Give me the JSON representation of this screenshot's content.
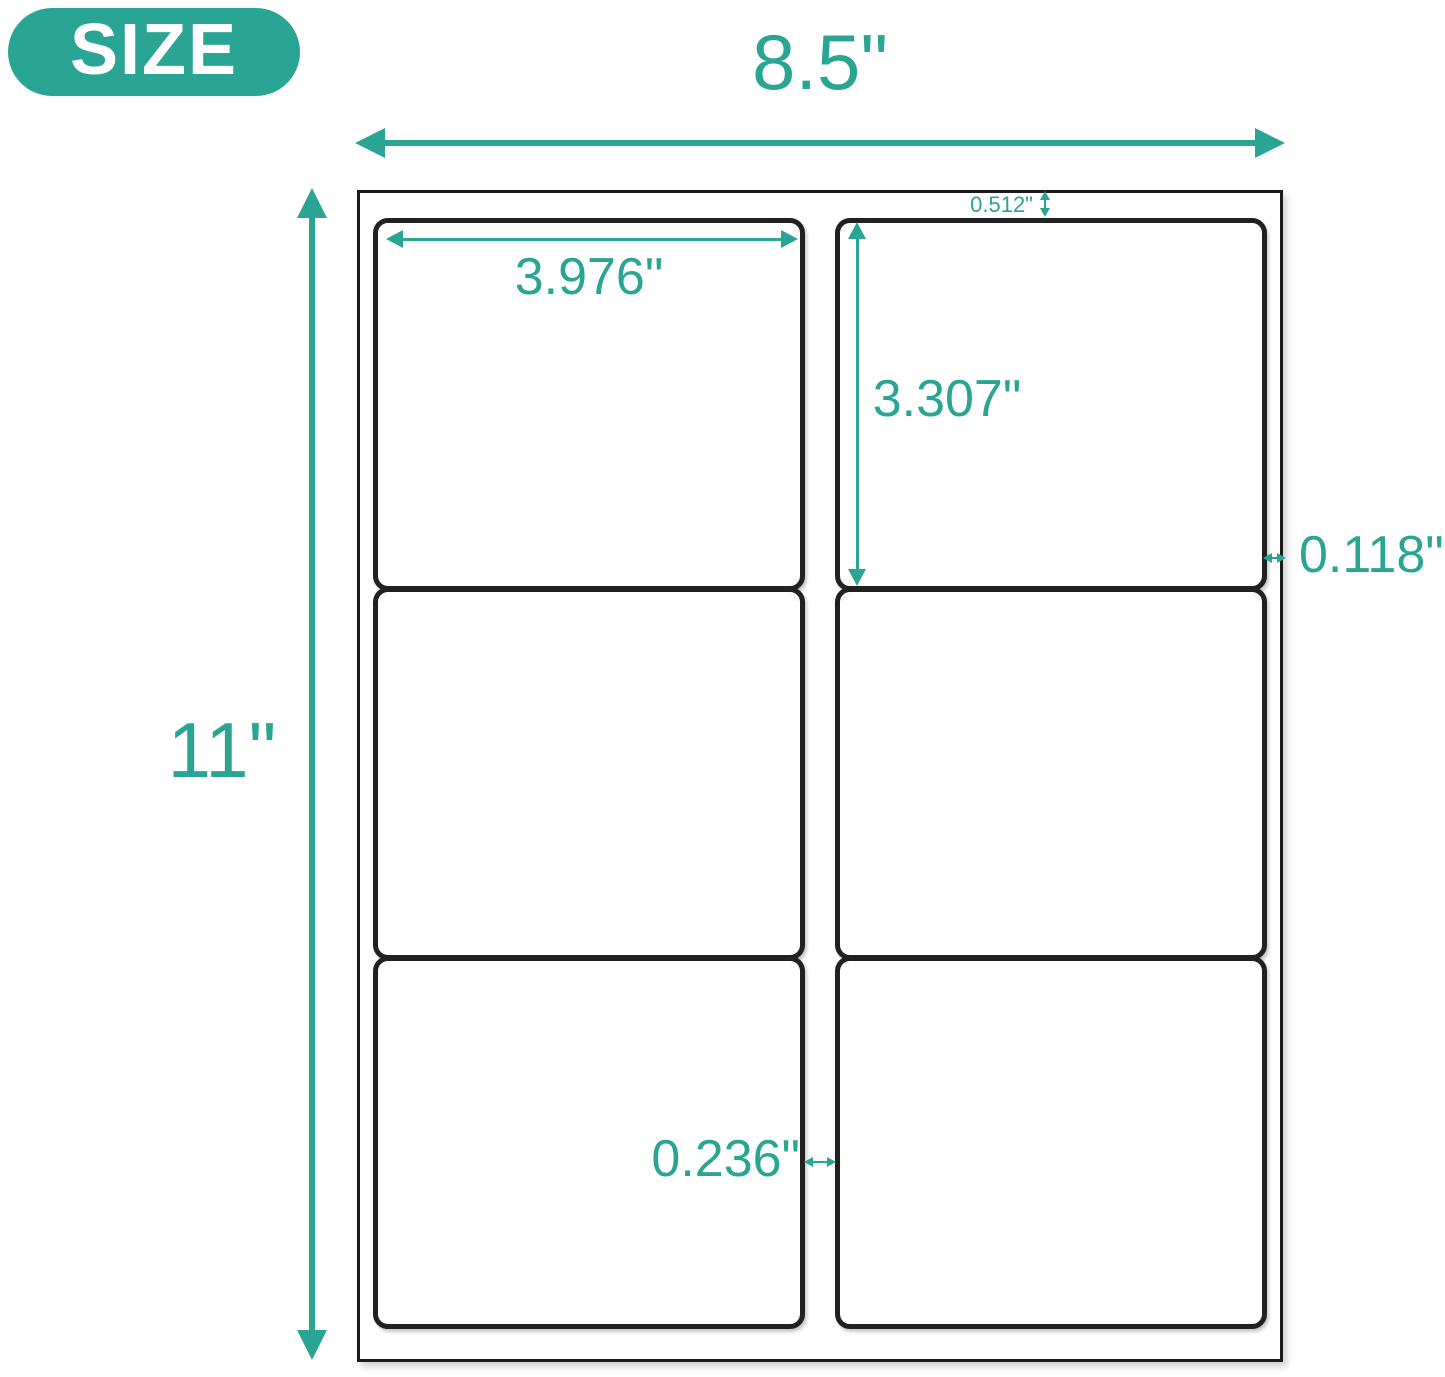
{
  "accent_color": "#2BA593",
  "badge": {
    "label": "SIZE"
  },
  "sheet": {
    "width": "8.5\"",
    "height": "11\"",
    "top_margin": "0.512\"",
    "side_margin": "0.118\"",
    "column_gap": "0.236\"",
    "label": {
      "width": "3.976\"",
      "height": "3.307\""
    },
    "grid": {
      "columns": 2,
      "rows": 3,
      "label_count": 6
    }
  }
}
